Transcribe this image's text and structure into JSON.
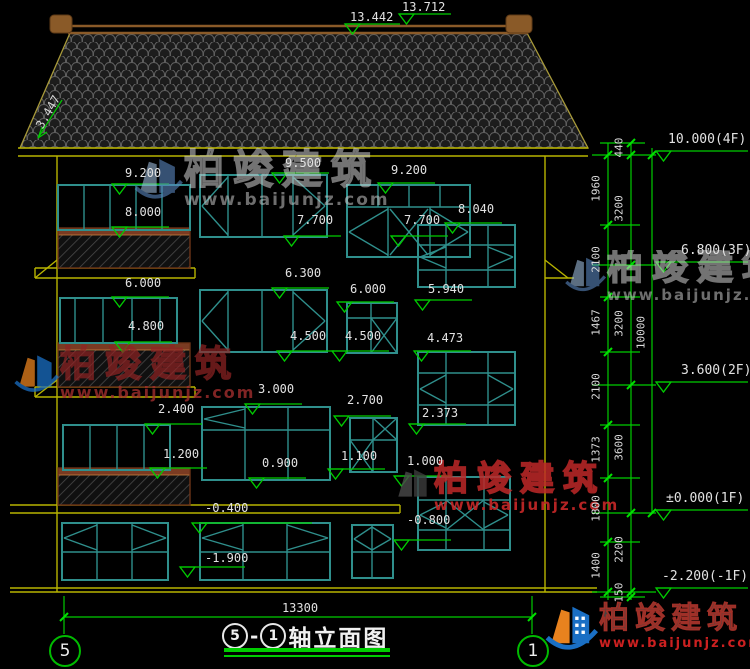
{
  "title": {
    "axis_a": "5",
    "sep": "-",
    "axis_b": "1",
    "name": "轴立面图"
  },
  "bottom": {
    "width_dim": "13300",
    "axis_left": "5",
    "axis_right": "1"
  },
  "roof": {
    "slope_label": "3.447"
  },
  "watermark": {
    "cn": "柏竣建筑",
    "url": "www.baijunjz.com"
  },
  "corner_logo": {
    "cn": "柏竣建筑",
    "url": "www.baijunjz.com"
  },
  "colors": {
    "dim_green": "#00cc00",
    "frame_teal": "#2f8f8c",
    "wall_yellow": "#b8b400",
    "ridge_brown": "#8a5a28",
    "rail_brown": "#7a3b22",
    "text": "#e2e2e2",
    "logo_blue": "#1a6fc4",
    "logo_orange": "#e8821e",
    "wm_red": "#cc2020"
  },
  "markers": {
    "top": [
      {
        "t": "13.442",
        "tx": 350,
        "ty": 10,
        "lx": 345,
        "ly": 24,
        "ll": 55
      },
      {
        "t": "13.712",
        "tx": 402,
        "ty": 0,
        "lx": 399,
        "ly": 14,
        "ll": 52
      }
    ],
    "levels": [
      {
        "t": "10.000(4F)",
        "tx": 668,
        "ty": 132,
        "lx": 656,
        "ly": 151,
        "ll": 92
      },
      {
        "t": "6.800(3F)",
        "tx": 681,
        "ty": 243,
        "lx": 656,
        "ly": 262,
        "ll": 92
      },
      {
        "t": "3.600(2F)",
        "tx": 681,
        "ty": 363,
        "lx": 656,
        "ly": 382,
        "ll": 92
      },
      {
        "t": "±0.000(1F)",
        "tx": 666,
        "ty": 491,
        "lx": 656,
        "ly": 510,
        "ll": 92
      },
      {
        "t": "-2.200(-1F)",
        "tx": 662,
        "ty": 569,
        "lx": 656,
        "ly": 588,
        "ll": 92
      }
    ],
    "facade": [
      {
        "t": "9.200",
        "tx": 125,
        "ty": 166,
        "ly": 184
      },
      {
        "t": "8.000",
        "tx": 125,
        "ty": 205,
        "ly": 227
      },
      {
        "t": "9.500",
        "tx": 285,
        "ty": 156,
        "ly": 173
      },
      {
        "t": "9.200",
        "tx": 391,
        "ty": 163,
        "ly": 183
      },
      {
        "t": "7.700",
        "tx": 297,
        "ty": 213,
        "ly": 236
      },
      {
        "t": "7.700",
        "tx": 404,
        "ty": 213,
        "ly": 236
      },
      {
        "t": "8.040",
        "tx": 458,
        "ty": 202,
        "ly": 223
      },
      {
        "t": "6.300",
        "tx": 285,
        "ty": 266,
        "ly": 288
      },
      {
        "t": "6.000",
        "tx": 125,
        "ty": 276,
        "ly": 297
      },
      {
        "t": "6.000",
        "tx": 350,
        "ty": 282,
        "ly": 302
      },
      {
        "t": "5.940",
        "tx": 428,
        "ty": 282,
        "ly": 300
      },
      {
        "t": "4.800",
        "tx": 128,
        "ty": 319,
        "ly": 342
      },
      {
        "t": "4.500",
        "tx": 290,
        "ty": 329,
        "ly": 351
      },
      {
        "t": "4.500",
        "tx": 345,
        "ty": 329,
        "ly": 351
      },
      {
        "t": "4.473",
        "tx": 427,
        "ty": 331,
        "ly": 351
      },
      {
        "t": "3.000",
        "tx": 258,
        "ty": 382,
        "ly": 404
      },
      {
        "t": "2.700",
        "tx": 347,
        "ty": 393,
        "ly": 416
      },
      {
        "t": "2.400",
        "tx": 158,
        "ty": 402,
        "ly": 424
      },
      {
        "t": "2.373",
        "tx": 422,
        "ty": 406,
        "ly": 424
      },
      {
        "t": "1.200",
        "tx": 163,
        "ty": 447,
        "ly": 468
      },
      {
        "t": "1.100",
        "tx": 341,
        "ty": 449,
        "ly": 469
      },
      {
        "t": "0.900",
        "tx": 262,
        "ty": 456,
        "ly": 478
      },
      {
        "t": "1.000",
        "tx": 407,
        "ty": 454,
        "ly": 476
      },
      {
        "t": "-0.400",
        "tx": 205,
        "ty": 501,
        "ly": 523,
        "ll": 120
      },
      {
        "t": "-0.800",
        "tx": 407,
        "ty": 513,
        "ly": 540
      },
      {
        "t": "-1.900",
        "tx": 205,
        "ty": 551,
        "lx": 180,
        "ly": 567,
        "ll": 65
      }
    ]
  },
  "chains": {
    "labels": [
      {
        "t": "1960",
        "x": 596,
        "y": 190
      },
      {
        "t": "2100",
        "x": 596,
        "y": 261
      },
      {
        "t": "1467",
        "x": 596,
        "y": 324
      },
      {
        "t": "2100",
        "x": 596,
        "y": 388
      },
      {
        "t": "1373",
        "x": 596,
        "y": 451
      },
      {
        "t": "1800",
        "x": 596,
        "y": 510
      },
      {
        "t": "1400",
        "x": 596,
        "y": 567
      },
      {
        "t": "440",
        "x": 619,
        "y": 149
      },
      {
        "t": "3200",
        "x": 619,
        "y": 210
      },
      {
        "t": "3200",
        "x": 619,
        "y": 325
      },
      {
        "t": "3600",
        "x": 619,
        "y": 449
      },
      {
        "t": "2200",
        "x": 619,
        "y": 551
      },
      {
        "t": "150",
        "x": 619,
        "y": 594
      },
      {
        "t": "10000",
        "x": 641,
        "y": 334
      }
    ]
  },
  "geometry": {
    "roof_poly": "20,148 70,33 527,33 588,148",
    "ridge_lines": [
      [
        68,
        26,
        528,
        26
      ],
      [
        68,
        33,
        528,
        33
      ]
    ],
    "ornaments": [
      [
        50,
        15,
        22,
        18
      ],
      [
        506,
        15,
        26,
        18
      ]
    ],
    "rail_bars": [
      [
        58,
        228,
        132,
        7
      ],
      [
        58,
        343,
        132,
        7
      ],
      [
        58,
        468,
        132,
        7
      ]
    ],
    "rail_outlines": [
      [
        58,
        228,
        132,
        40
      ],
      [
        58,
        343,
        132,
        44
      ],
      [
        58,
        468,
        132,
        37
      ]
    ],
    "hatch_rects": [
      [
        58,
        235,
        132,
        33
      ],
      [
        58,
        350,
        132,
        37
      ],
      [
        58,
        475,
        132,
        30
      ]
    ],
    "yellow_lines": [
      [
        18,
        148,
        588,
        148
      ],
      [
        18,
        156,
        588,
        156
      ],
      [
        57,
        156,
        57,
        592
      ],
      [
        545,
        156,
        545,
        592
      ],
      [
        35,
        268,
        195,
        268
      ],
      [
        35,
        278,
        195,
        278
      ],
      [
        35,
        268,
        35,
        278
      ],
      [
        195,
        268,
        195,
        278
      ],
      [
        35,
        278,
        57,
        260
      ],
      [
        545,
        260,
        568,
        278
      ],
      [
        545,
        278,
        574,
        278
      ],
      [
        35,
        387,
        195,
        387
      ],
      [
        35,
        397,
        195,
        397
      ],
      [
        35,
        387,
        35,
        397
      ],
      [
        195,
        387,
        195,
        397
      ],
      [
        35,
        397,
        57,
        380
      ],
      [
        10,
        505,
        400,
        505
      ],
      [
        10,
        513,
        400,
        513
      ],
      [
        400,
        505,
        400,
        513
      ],
      [
        10,
        588,
        597,
        588
      ],
      [
        10,
        592,
        597,
        592
      ]
    ],
    "teal_rects": [
      [
        58,
        185,
        132,
        45
      ],
      [
        200,
        175,
        127,
        62
      ],
      [
        347,
        185,
        123,
        72
      ],
      [
        418,
        225,
        97,
        62
      ],
      [
        200,
        290,
        127,
        62
      ],
      [
        60,
        298,
        117,
        45
      ],
      [
        347,
        303,
        50,
        50
      ],
      [
        418,
        352,
        97,
        73
      ],
      [
        202,
        407,
        128,
        73
      ],
      [
        63,
        425,
        107,
        45
      ],
      [
        350,
        418,
        47,
        54
      ],
      [
        418,
        477,
        92,
        73
      ],
      [
        62,
        523,
        106,
        57
      ],
      [
        200,
        523,
        130,
        57
      ],
      [
        352,
        525,
        41,
        53
      ]
    ],
    "teal_lines": [
      [
        84,
        185,
        84,
        230
      ],
      [
        110,
        185,
        110,
        230
      ],
      [
        136,
        185,
        136,
        230
      ],
      [
        162,
        185,
        162,
        230
      ],
      [
        228,
        175,
        228,
        237
      ],
      [
        262,
        175,
        262,
        237
      ],
      [
        293,
        175,
        293,
        237
      ],
      [
        228,
        177,
        202,
        206
      ],
      [
        202,
        206,
        228,
        235
      ],
      [
        293,
        177,
        325,
        206
      ],
      [
        325,
        206,
        293,
        235
      ],
      [
        347,
        207,
        470,
        207
      ],
      [
        378,
        185,
        378,
        207
      ],
      [
        409,
        185,
        409,
        207
      ],
      [
        440,
        185,
        440,
        207
      ],
      [
        388,
        207,
        388,
        257
      ],
      [
        430,
        207,
        430,
        257
      ],
      [
        388,
        209,
        349,
        232
      ],
      [
        349,
        232,
        388,
        255
      ],
      [
        430,
        209,
        468,
        232
      ],
      [
        468,
        232,
        430,
        255
      ],
      [
        390,
        209,
        428,
        255
      ],
      [
        428,
        209,
        390,
        255
      ],
      [
        418,
        245,
        515,
        245
      ],
      [
        418,
        270,
        515,
        270
      ],
      [
        446,
        225,
        446,
        287
      ],
      [
        488,
        225,
        488,
        287
      ],
      [
        446,
        247,
        420,
        257
      ],
      [
        420,
        257,
        446,
        268
      ],
      [
        488,
        247,
        513,
        257
      ],
      [
        513,
        257,
        488,
        268
      ],
      [
        228,
        290,
        228,
        352
      ],
      [
        262,
        290,
        262,
        352
      ],
      [
        293,
        290,
        293,
        352
      ],
      [
        228,
        292,
        202,
        321
      ],
      [
        202,
        321,
        228,
        350
      ],
      [
        293,
        292,
        325,
        321
      ],
      [
        325,
        321,
        293,
        350
      ],
      [
        75,
        298,
        75,
        343
      ],
      [
        103,
        298,
        103,
        343
      ],
      [
        132,
        298,
        132,
        343
      ],
      [
        160,
        298,
        160,
        343
      ],
      [
        371,
        303,
        371,
        353
      ],
      [
        347,
        318,
        397,
        318
      ],
      [
        371,
        318,
        397,
        353
      ],
      [
        397,
        318,
        371,
        353
      ],
      [
        418,
        373,
        515,
        373
      ],
      [
        418,
        405,
        515,
        405
      ],
      [
        446,
        352,
        446,
        425
      ],
      [
        488,
        352,
        488,
        425
      ],
      [
        446,
        375,
        420,
        389
      ],
      [
        420,
        389,
        446,
        403
      ],
      [
        488,
        375,
        513,
        389
      ],
      [
        513,
        389,
        488,
        403
      ],
      [
        202,
        430,
        330,
        430
      ],
      [
        245,
        407,
        245,
        480
      ],
      [
        288,
        407,
        288,
        480
      ],
      [
        245,
        409,
        204,
        419
      ],
      [
        204,
        419,
        245,
        428
      ],
      [
        90,
        425,
        90,
        470
      ],
      [
        117,
        425,
        117,
        470
      ],
      [
        144,
        425,
        144,
        470
      ],
      [
        373,
        418,
        373,
        472
      ],
      [
        350,
        440,
        397,
        440
      ],
      [
        350,
        440,
        373,
        472
      ],
      [
        373,
        440,
        350,
        472
      ],
      [
        373,
        418,
        397,
        440
      ],
      [
        397,
        418,
        373,
        440
      ],
      [
        418,
        500,
        510,
        500
      ],
      [
        418,
        530,
        510,
        530
      ],
      [
        446,
        477,
        446,
        550
      ],
      [
        484,
        477,
        484,
        550
      ],
      [
        446,
        502,
        420,
        515
      ],
      [
        420,
        515,
        446,
        528
      ],
      [
        484,
        502,
        508,
        515
      ],
      [
        508,
        515,
        484,
        528
      ],
      [
        446,
        500,
        484,
        530
      ],
      [
        484,
        500,
        446,
        530
      ],
      [
        97,
        523,
        97,
        580
      ],
      [
        132,
        523,
        132,
        580
      ],
      [
        62,
        552,
        168,
        552
      ],
      [
        97,
        525,
        64,
        538
      ],
      [
        64,
        538,
        97,
        550
      ],
      [
        132,
        525,
        166,
        538
      ],
      [
        166,
        538,
        132,
        550
      ],
      [
        243,
        523,
        243,
        580
      ],
      [
        287,
        523,
        287,
        580
      ],
      [
        200,
        552,
        330,
        552
      ],
      [
        243,
        525,
        202,
        538
      ],
      [
        202,
        538,
        243,
        550
      ],
      [
        287,
        525,
        328,
        538
      ],
      [
        328,
        538,
        287,
        550
      ],
      [
        372,
        525,
        372,
        578
      ],
      [
        352,
        552,
        393,
        552
      ],
      [
        372,
        527,
        354,
        539
      ],
      [
        354,
        539,
        372,
        550
      ],
      [
        372,
        527,
        391,
        539
      ],
      [
        391,
        539,
        372,
        550
      ]
    ],
    "green_lines": [
      [
        592,
        155,
        656,
        155
      ],
      [
        592,
        265,
        656,
        265
      ],
      [
        592,
        385,
        656,
        385
      ],
      [
        592,
        513,
        656,
        513
      ],
      [
        592,
        592,
        656,
        592
      ],
      [
        600,
        143,
        645,
        143
      ],
      [
        600,
        225,
        640,
        225
      ],
      [
        600,
        297,
        640,
        297
      ],
      [
        600,
        352,
        640,
        352
      ],
      [
        600,
        425,
        640,
        425
      ],
      [
        600,
        478,
        640,
        478
      ],
      [
        600,
        542,
        640,
        542
      ],
      [
        600,
        597,
        645,
        597
      ],
      [
        608,
        143,
        608,
        600
      ],
      [
        631,
        143,
        631,
        600
      ],
      [
        652,
        148,
        652,
        513
      ],
      [
        64,
        596,
        64,
        634
      ],
      [
        532,
        596,
        532,
        634
      ],
      [
        64,
        617,
        532,
        617
      ],
      [
        62,
        100,
        38,
        138
      ],
      [
        38,
        138,
        42,
        127
      ],
      [
        38,
        138,
        47,
        132
      ]
    ],
    "ticks": [
      [
        608,
        155
      ],
      [
        608,
        225
      ],
      [
        608,
        297
      ],
      [
        608,
        352
      ],
      [
        608,
        425
      ],
      [
        608,
        478
      ],
      [
        608,
        542
      ],
      [
        608,
        592
      ],
      [
        631,
        143
      ],
      [
        631,
        155
      ],
      [
        631,
        265
      ],
      [
        631,
        385
      ],
      [
        631,
        513
      ],
      [
        631,
        592
      ],
      [
        631,
        597
      ],
      [
        652,
        155
      ],
      [
        652,
        513
      ],
      [
        64,
        617
      ],
      [
        532,
        617
      ]
    ]
  }
}
